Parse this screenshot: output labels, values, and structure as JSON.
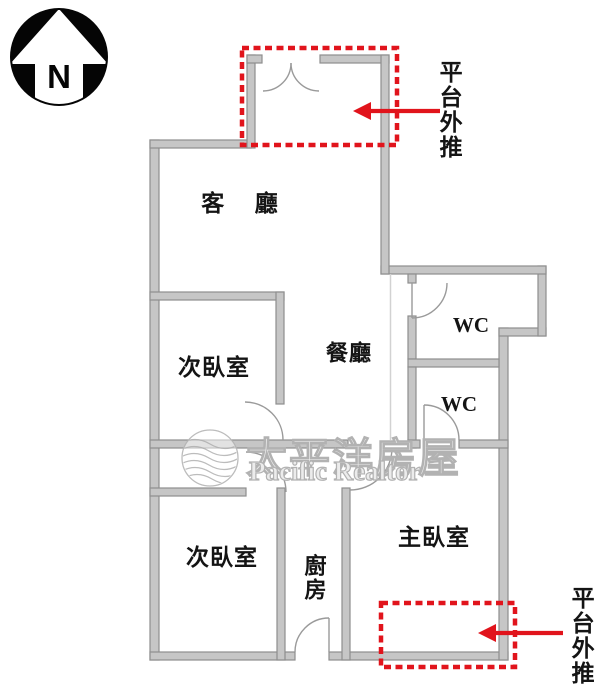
{
  "compass": {
    "letter": "N"
  },
  "rooms": {
    "living": {
      "label": "客 廳"
    },
    "bedroom_upper": {
      "label": "次臥室"
    },
    "dining": {
      "label": "餐廳"
    },
    "wc_upper": {
      "label": "WC"
    },
    "wc_lower": {
      "label": "WC"
    },
    "bedroom_lower": {
      "label": "次臥室"
    },
    "kitchen": {
      "label": "廚房"
    },
    "master": {
      "label": "主臥室"
    }
  },
  "annotations": {
    "top_platform": {
      "label": "平台外推"
    },
    "bottom_platform": {
      "label": "平台外推"
    }
  },
  "watermark": {
    "cjk": "太平洋房屋",
    "latin": "Pacific Realtor"
  },
  "colors": {
    "wall_fill": "#c6c6c6",
    "wall_edge": "#8e8e8e",
    "annotation_red": "#e1141c",
    "compass_black": "#050505",
    "watermark_gray": "#b2b2b2"
  }
}
